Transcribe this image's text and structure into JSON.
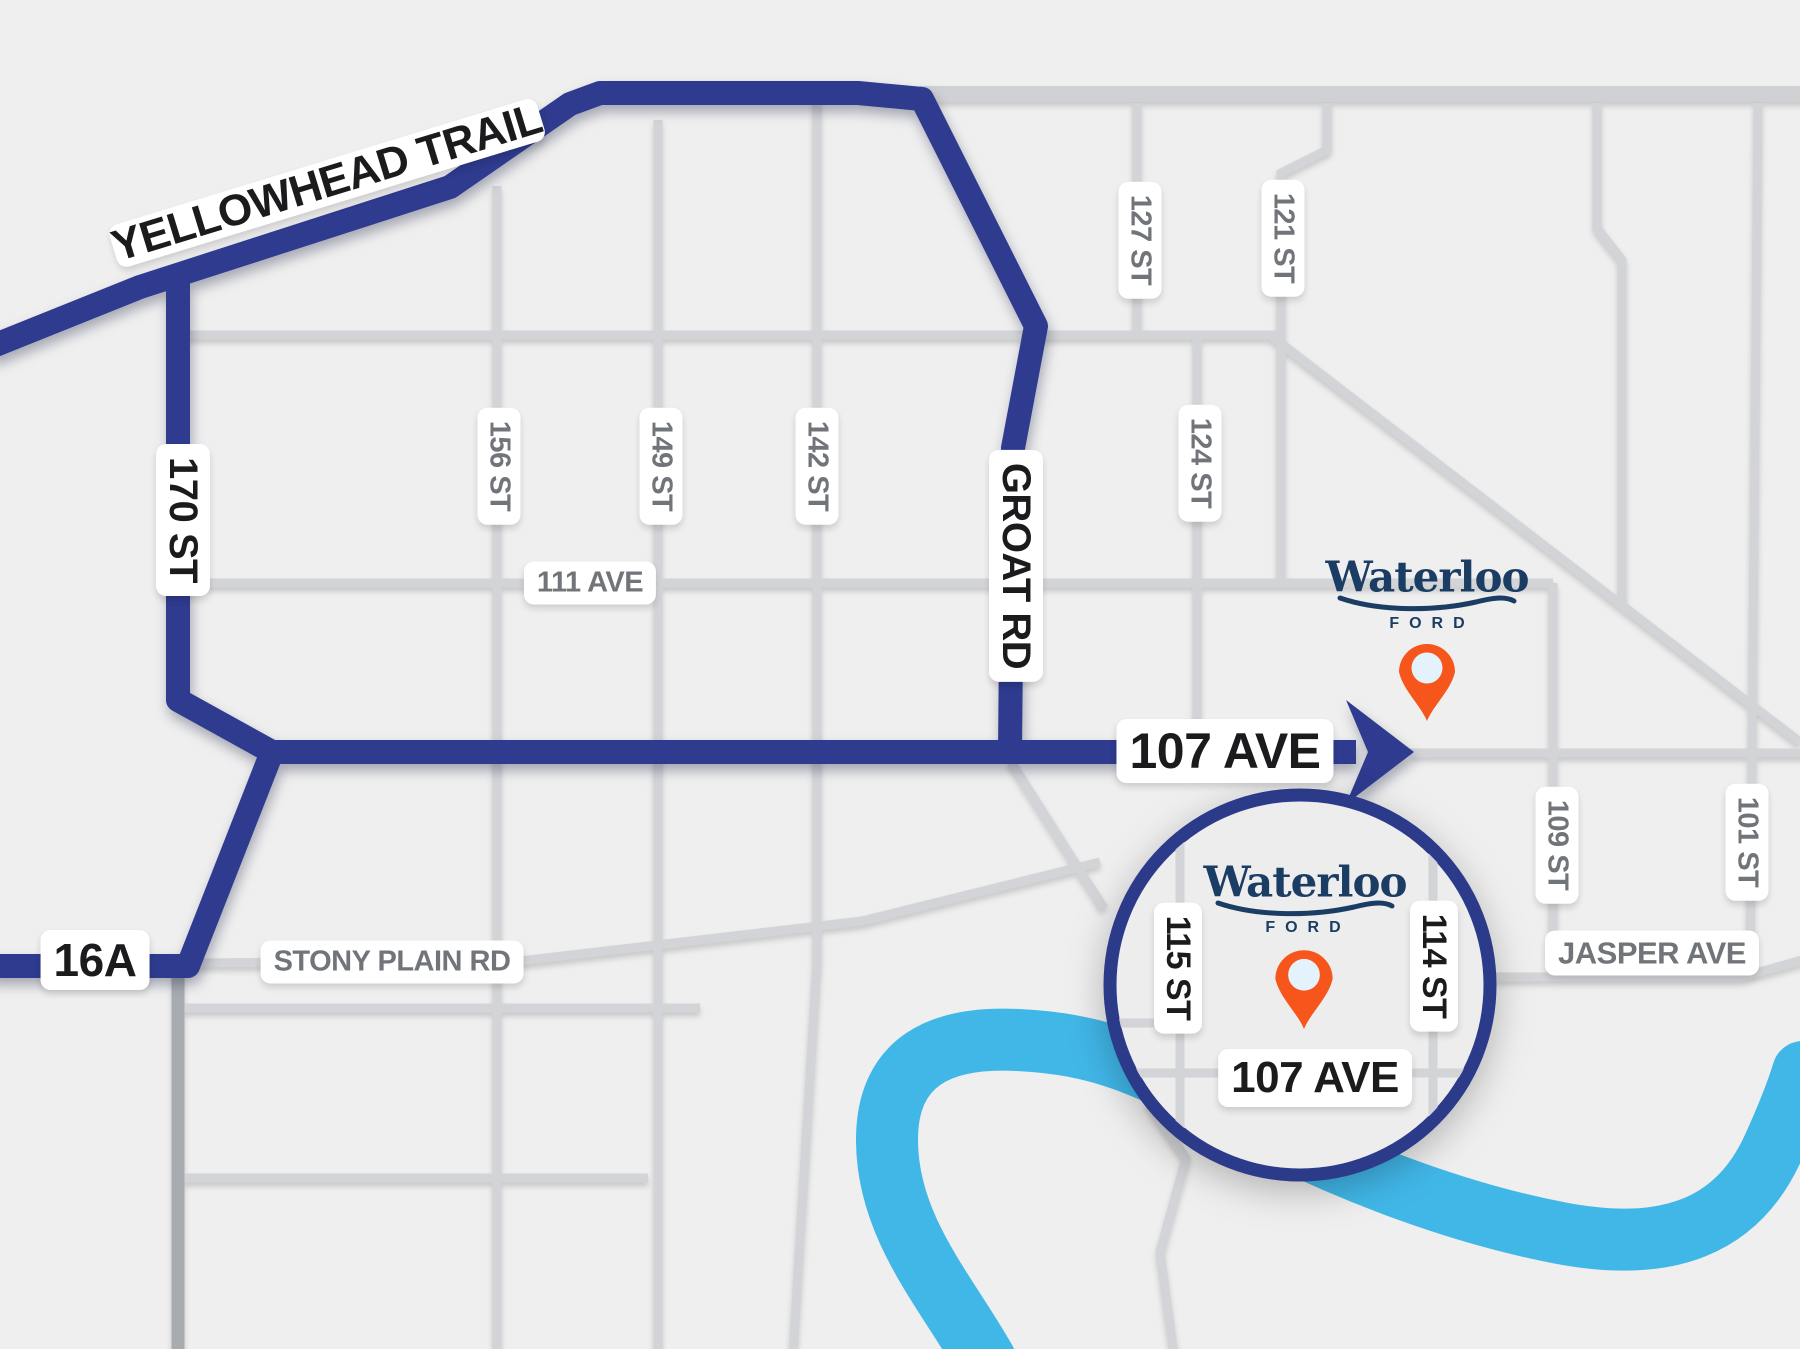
{
  "colors": {
    "bg": "#efefef",
    "road": "#d2d4d7",
    "road_dark": "#a8acb1",
    "route": "#2e3b8e",
    "river": "#41b7e8",
    "pin": "#f6551b",
    "pin_inner": "#e4f2fb",
    "logo": "#1b3d63",
    "label_minor": "#71757a",
    "label_major": "#1b1b1d",
    "circle_border": "#2c3a8a",
    "circle_fill": "#ededee"
  },
  "highways": {
    "yellowhead": "YELLOWHEAD TRAIL",
    "st170": "170 ST",
    "groat": "GROAT RD",
    "ave107": "107 AVE",
    "hwy16a": "16A"
  },
  "streets": {
    "st156": "156 ST",
    "st149": "149 ST",
    "st142": "142 ST",
    "st127": "127 ST",
    "st121": "121 ST",
    "st124": "124 ST",
    "ave111": "111 AVE",
    "stony": "STONY PLAIN RD",
    "jasper": "JASPER AVE",
    "st109": "109 ST",
    "st101": "101 ST"
  },
  "inset": {
    "st115": "115 ST",
    "st114": "114 ST",
    "ave107": "107 AVE"
  },
  "dealership": {
    "name": "Waterloo",
    "division": "FORD"
  }
}
